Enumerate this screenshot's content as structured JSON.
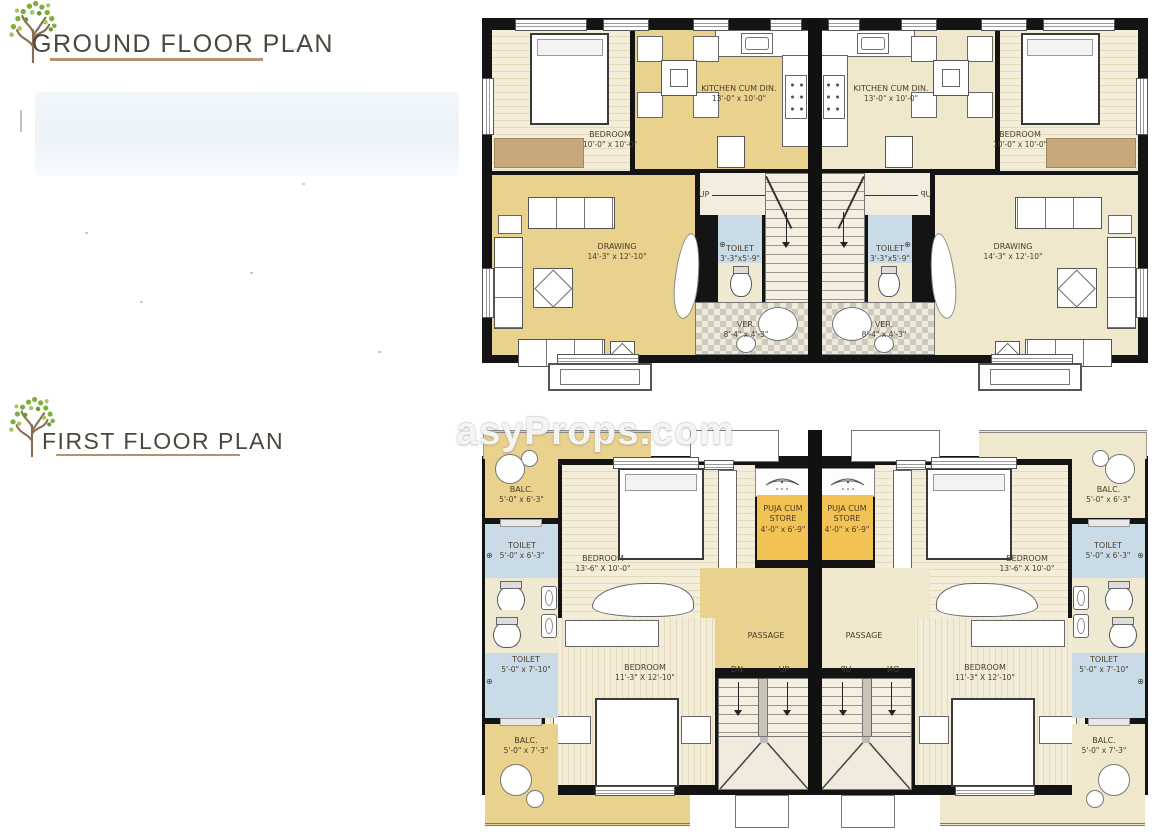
{
  "sheet": {
    "watermark": "asyProps.com",
    "ground_floor_title": "GROUND FLOOR PLAN",
    "first_floor_title": "FIRST FLOOR PLAN"
  },
  "gf": {
    "bedroom": {
      "name": "BEDROOM",
      "dim": "10'-0\" x 10'-0\""
    },
    "kitchen": {
      "name": "KITCHEN CUM DIN.",
      "dim": "13'-0\" x 10'-0\""
    },
    "drawing": {
      "name": "DRAWING",
      "dim": "14'-3\" x 12'-10\""
    },
    "toilet": {
      "name": "TOILET",
      "dim": "3'-3\"x5'-9\""
    },
    "ver": {
      "name": "VER.",
      "dim": "8'-4\" x 4'-3\""
    },
    "up": "UP"
  },
  "ff": {
    "balc_top": {
      "name": "BALC.",
      "dim": "5'-0\" x 6'-3\""
    },
    "toilet_top": {
      "name": "TOILET",
      "dim": "5'-0\" x 6'-3\""
    },
    "bedroom_top": {
      "name": "BEDROOM",
      "dim": "13'-6\" X 10'-0\""
    },
    "puja": {
      "name": "PUJA CUM STORE",
      "dim": "4'-0\" x 6'-9\""
    },
    "passage": "PASSAGE",
    "dn": "DN",
    "up": "UP",
    "bedroom_bottom": {
      "name": "BEDROOM",
      "dim": "11'-3\" X 12'-10\""
    },
    "toilet_bottom": {
      "name": "TOILET",
      "dim": "5'-0\" x 7'-10\""
    },
    "balc_bottom": {
      "name": "BALC.",
      "dim": "5'-0\" x 7'-3\""
    }
  },
  "colors": {
    "left_unit_fill": "#e9d18e",
    "right_unit_fill": "#f0e8cd",
    "puja_fill": "#f2c254",
    "toilet_blue": "#c8dbe7",
    "title_underline": "#b3926f",
    "tree_green": "#7fae3c",
    "wall": "#141414"
  }
}
